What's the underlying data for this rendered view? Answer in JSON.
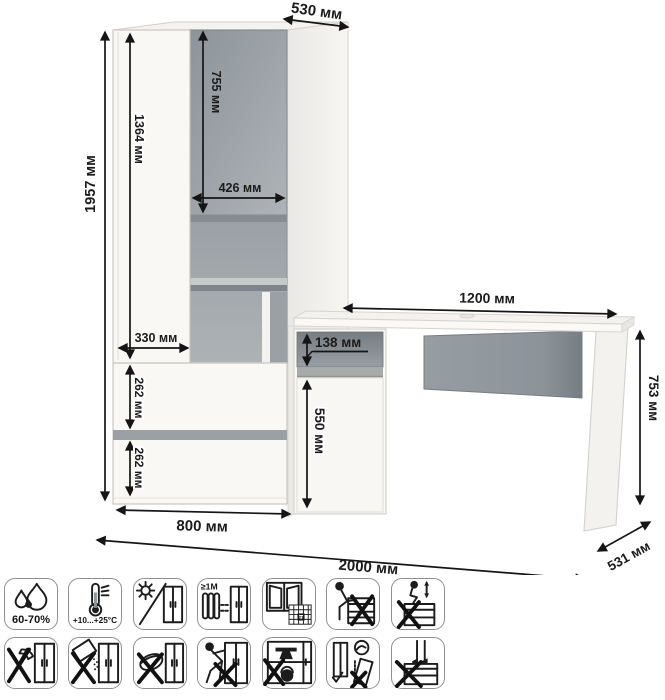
{
  "diagram_title": "furniture-dimensions-wardrobe-with-desk",
  "unit": "мм",
  "dims": {
    "depth_top": "530 мм",
    "height": "1957 мм",
    "left_door_height": "1364 мм",
    "gray_door_height": "755 мм",
    "gray_door_width": "426 мм",
    "left_door_width": "330 мм",
    "drawer1_height": "262 мм",
    "drawer2_height": "262 мм",
    "wardrobe_width": "800 мм",
    "desk_width": "1200 мм",
    "desk_drawer_height": "138 мм",
    "desk_door_height": "550 мм",
    "desk_height": "753 мм",
    "desk_depth": "531 мм",
    "total_width": "2000 мм"
  },
  "colors": {
    "accent_gray": "#959ca2",
    "dark_gray": "#7d848a",
    "line": "#1b1b1b",
    "furniture_white": "#f9f8f4"
  },
  "icons": {
    "humidity": "60-70%",
    "temperature": "+10...+25°C",
    "min_distance": "≥1M",
    "calendar_day": "21",
    "row1": [
      "humidity-range",
      "temperature-range",
      "avoid-sunlight",
      "keep-1m-from-heat",
      "ventilate-room",
      "do-not-sit",
      "do-not-jump"
    ],
    "row2": [
      "no-sharp-impacts",
      "no-spilling",
      "no-abrasive-cleaning",
      "do-not-drag",
      "do-not-overload",
      "anchor-to-wall",
      "do-not-stand"
    ]
  }
}
